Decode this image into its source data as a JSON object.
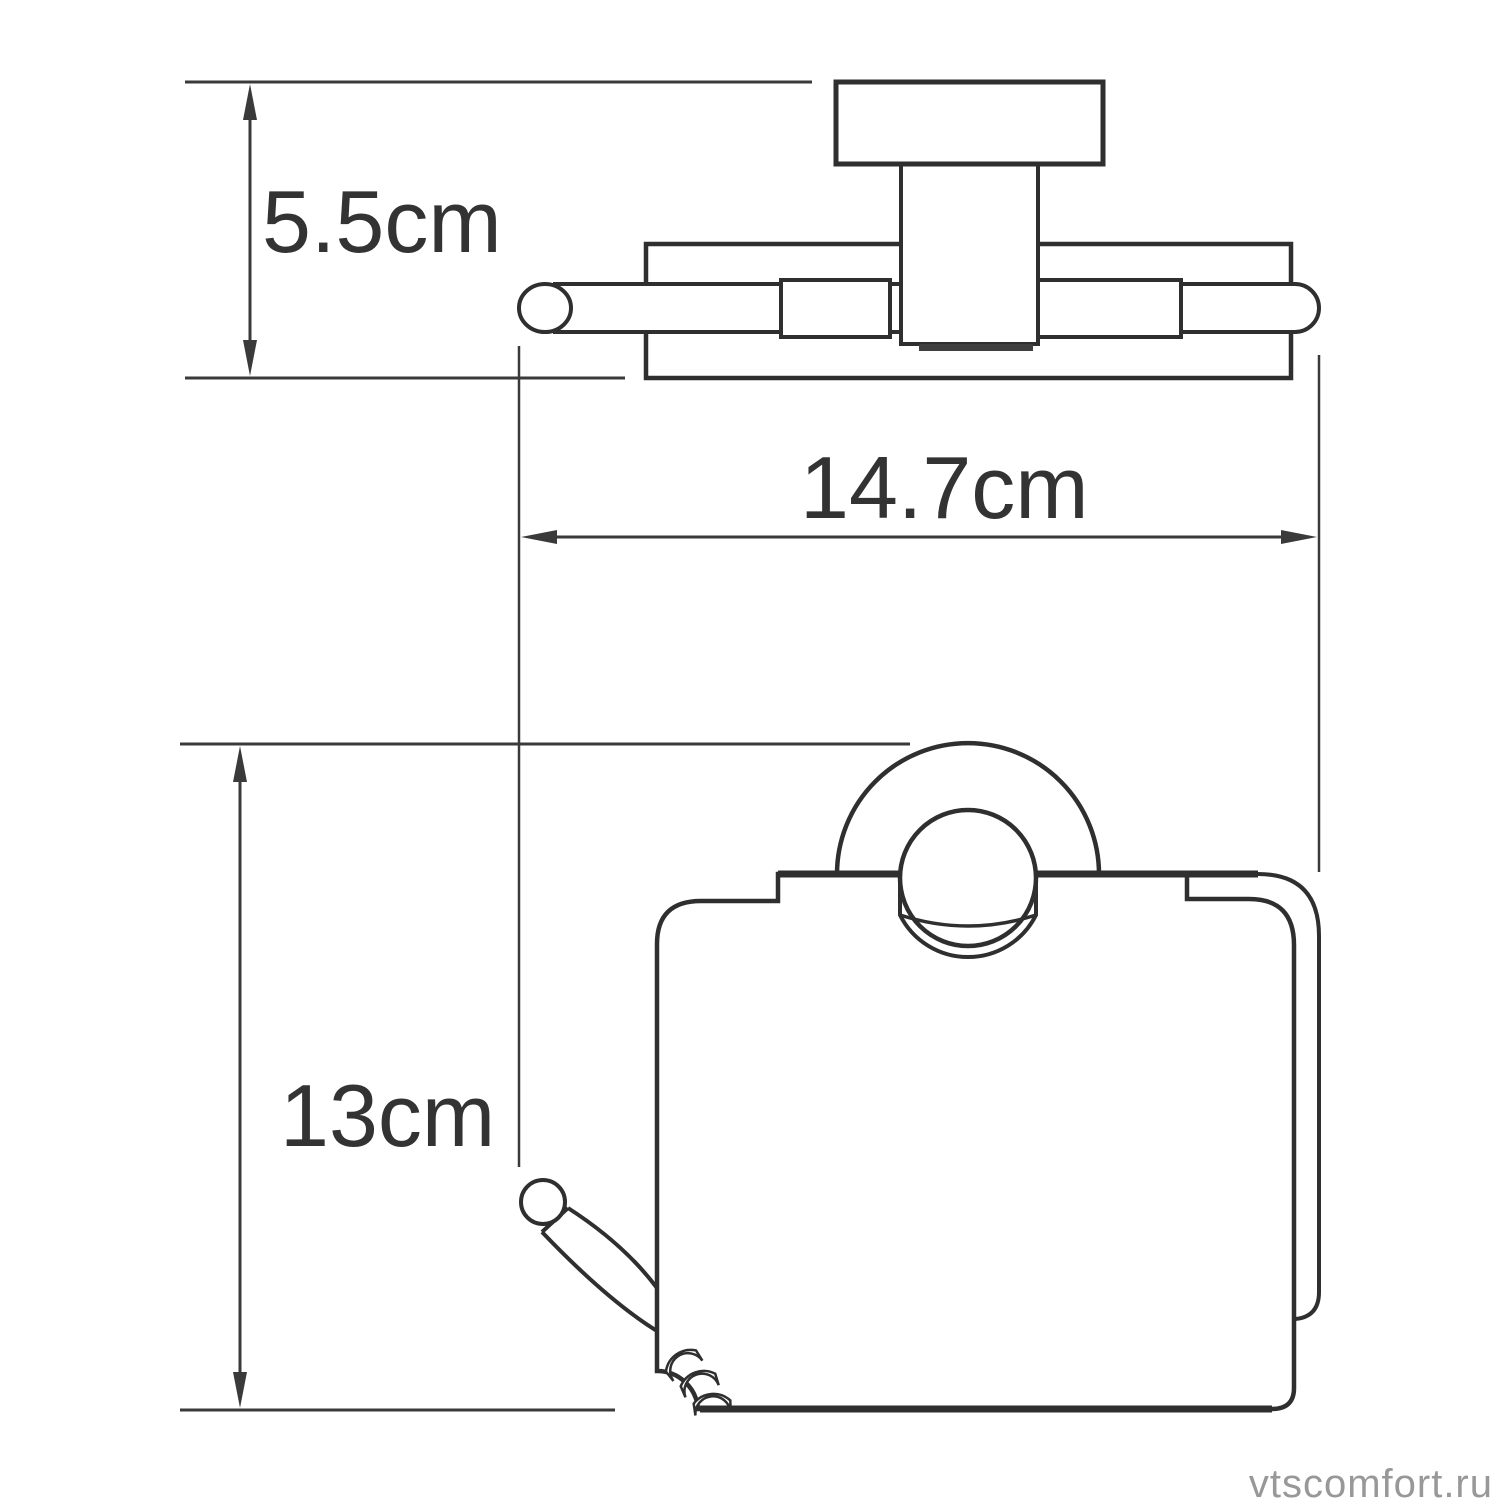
{
  "drawing": {
    "title": "toilet-paper-holder-dimension-drawing",
    "views": [
      {
        "id": "top-view"
      },
      {
        "id": "front-view"
      }
    ]
  },
  "dimensions": [
    {
      "label": "5.5cm",
      "value_cm": 5.5,
      "axis": "vertical",
      "view": "top-view"
    },
    {
      "label": "14.7cm",
      "value_cm": 14.7,
      "axis": "horizontal",
      "view": "top-view"
    },
    {
      "label": "13cm",
      "value_cm": 13,
      "axis": "vertical",
      "view": "front-view"
    }
  ],
  "watermark": {
    "text": "vtscomfort.ru",
    "color": "#989898"
  },
  "style": {
    "line_color": "#2f2f2f",
    "dim_color": "#3a3a3a",
    "text_color": "#333333",
    "background": "#ffffff"
  }
}
